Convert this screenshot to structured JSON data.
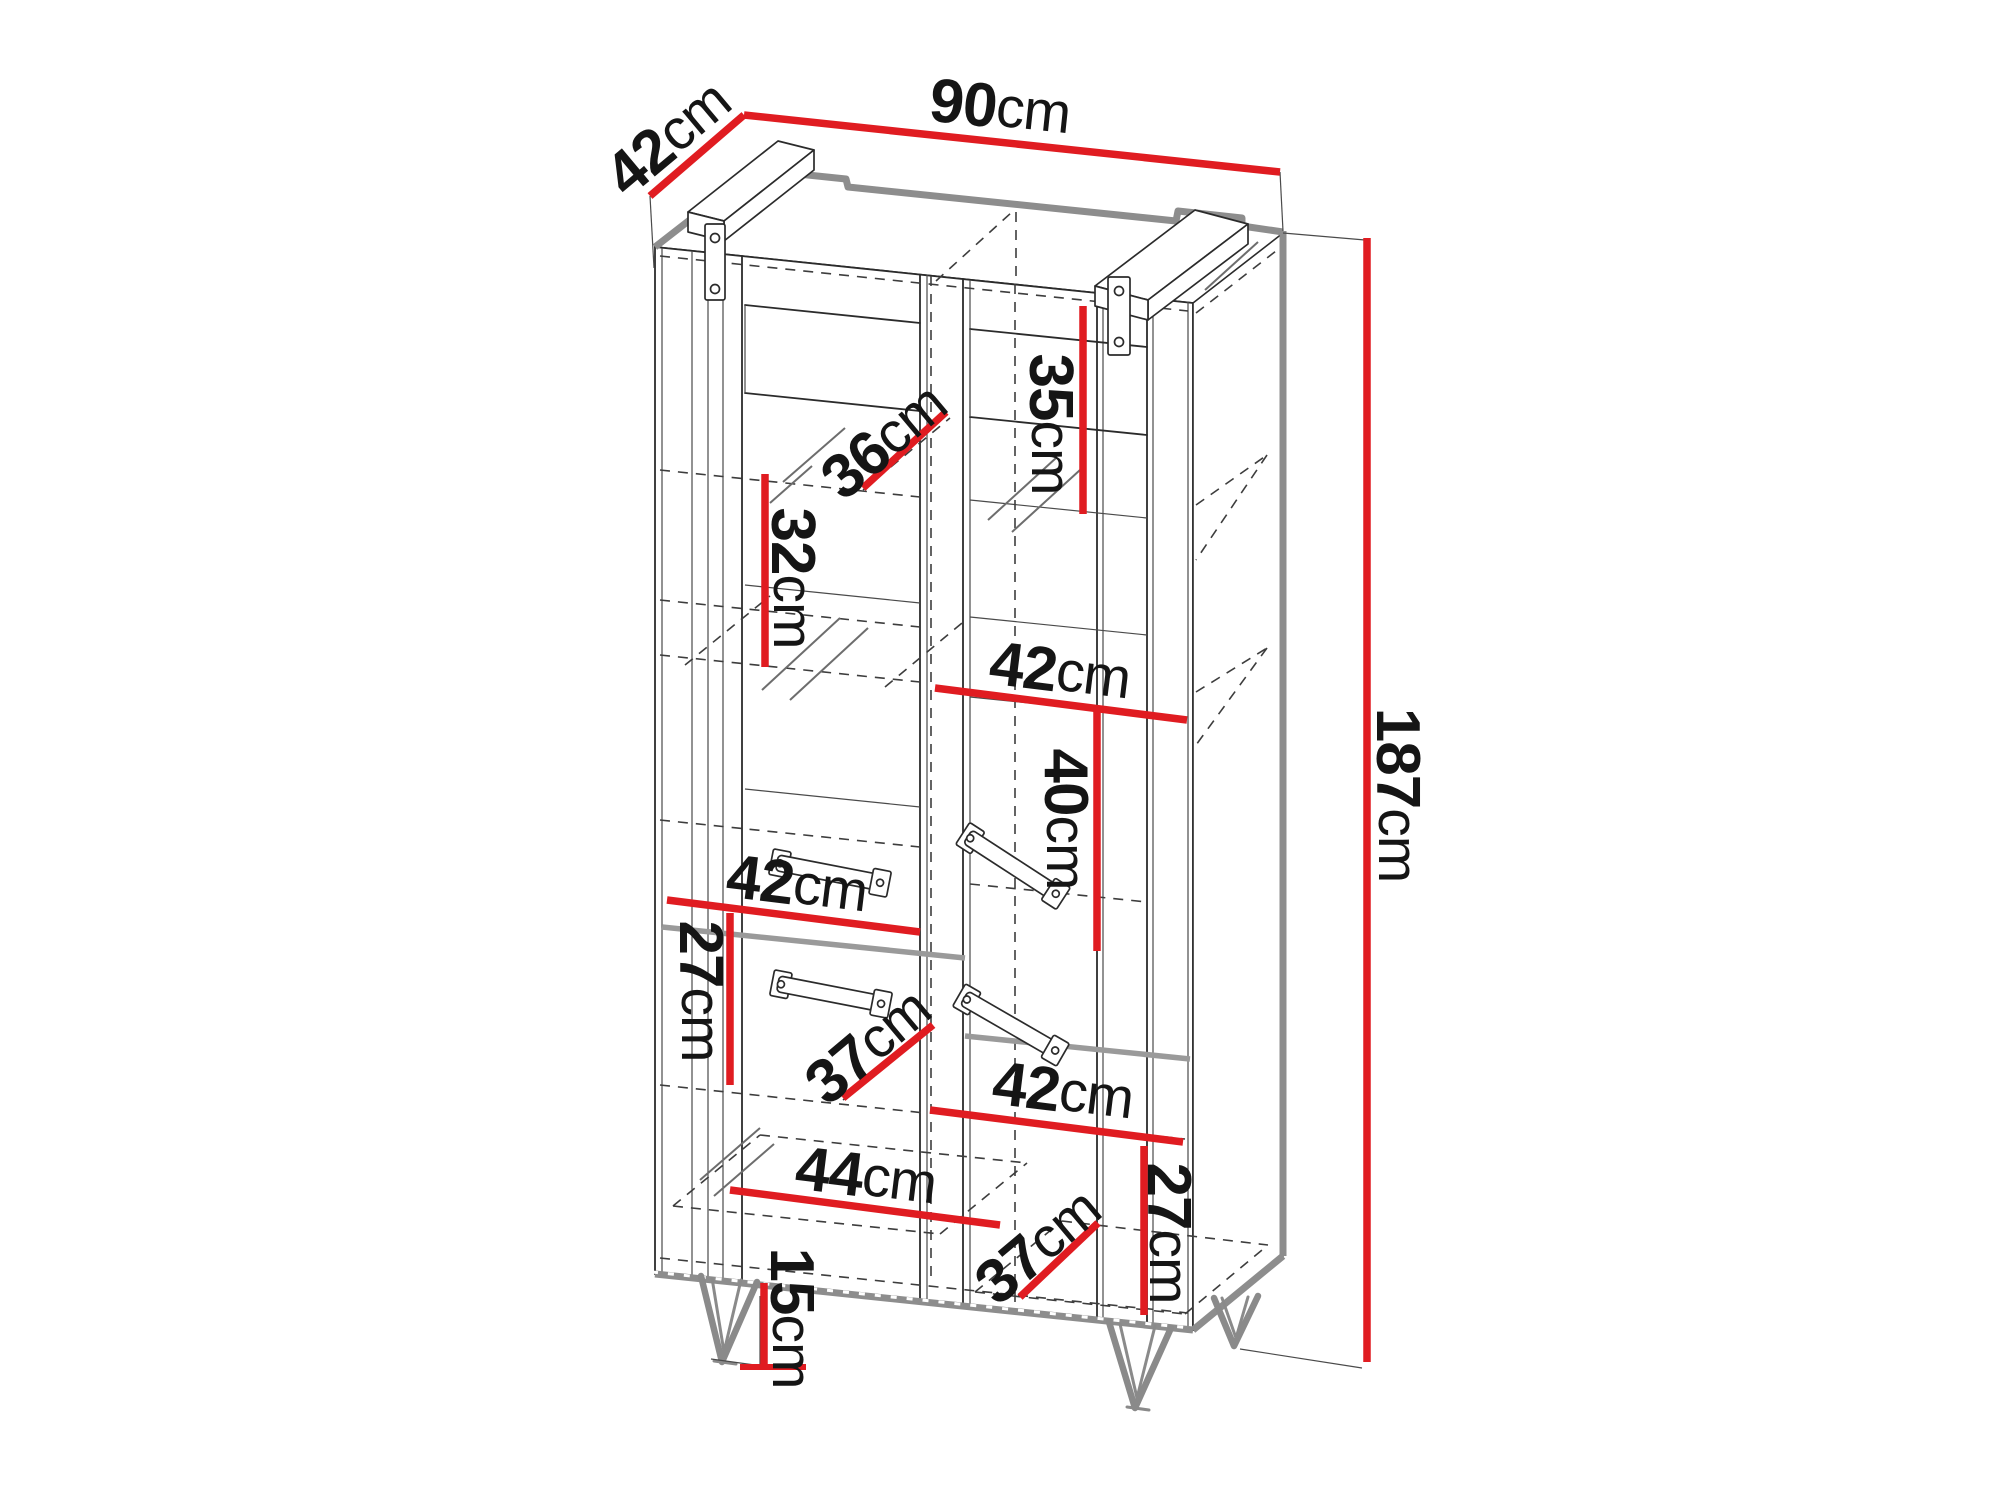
{
  "page": {
    "background": "#ffffff"
  },
  "diagram": {
    "kind": "furniture-dimension-drawing",
    "subject": "two-door display cabinet with drawers and hairpin legs",
    "unit_default": "cm",
    "accent_color": "#e01c21",
    "ink_color": "#2b2b2b",
    "shadow_color": "#8d8d8d",
    "dimensions": [
      {
        "id": "top-depth",
        "value": 42,
        "value_text": "42",
        "unit": "cm"
      },
      {
        "id": "top-width",
        "value": 90,
        "value_text": "90",
        "unit": "cm"
      },
      {
        "id": "overall-height",
        "value": 187,
        "value_text": "187",
        "unit": "cm"
      },
      {
        "id": "upper-shelf-depth",
        "value": 36,
        "value_text": "36",
        "unit": "cm"
      },
      {
        "id": "upper-right-shelf-height",
        "value": 35,
        "value_text": "35",
        "unit": "cm"
      },
      {
        "id": "upper-left-shelf-height",
        "value": 32,
        "value_text": "32",
        "unit": "cm"
      },
      {
        "id": "middle-right-width",
        "value": 42,
        "value_text": "42",
        "unit": "cm"
      },
      {
        "id": "middle-right-height",
        "value": 40,
        "value_text": "40",
        "unit": "cm"
      },
      {
        "id": "middle-left-width",
        "value": 42,
        "value_text": "42",
        "unit": "cm"
      },
      {
        "id": "lower-left-shelf-height",
        "value": 27,
        "value_text": "27",
        "unit": "cm"
      },
      {
        "id": "lower-middle-depth",
        "value": 37,
        "value_text": "37",
        "unit": "cm"
      },
      {
        "id": "lower-right-width",
        "value": 42,
        "value_text": "42",
        "unit": "cm"
      },
      {
        "id": "lower-right-shelf-height",
        "value": 27,
        "value_text": "27",
        "unit": "cm"
      },
      {
        "id": "bottom-inner-width",
        "value": 44,
        "value_text": "44",
        "unit": "cm"
      },
      {
        "id": "bottom-right-depth",
        "value": 37,
        "value_text": "37",
        "unit": "cm"
      },
      {
        "id": "leg-height",
        "value": 15,
        "value_text": "15",
        "unit": "cm"
      }
    ]
  }
}
